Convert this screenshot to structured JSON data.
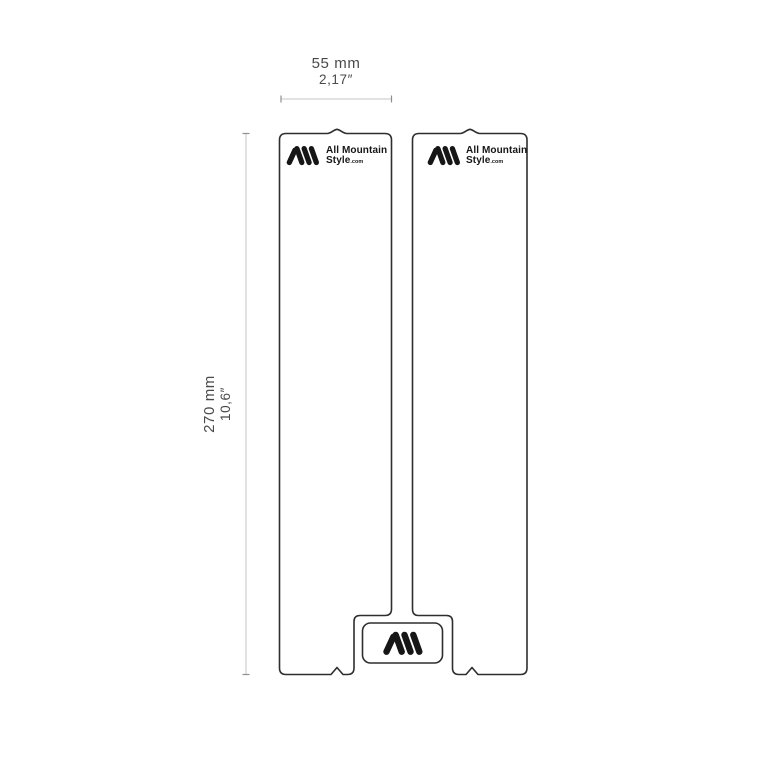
{
  "page": {
    "background": "#ffffff"
  },
  "diagram": {
    "type": "product-dimension-drawing",
    "width_dimension": {
      "metric": "55 mm",
      "imperial": "2,17″"
    },
    "height_dimension": {
      "metric": "270 mm",
      "imperial": "10,6″"
    }
  },
  "brand": {
    "line1": "All Mountain",
    "line2": "Style",
    "suffix": ".com",
    "logo_icon": "ams-triple-stroke-mark"
  },
  "colors": {
    "outline": "#2e2e2e",
    "logo": "#161616",
    "dimension_line": "#c6c6c6",
    "dimension_tick": "#8f8f8f",
    "dimension_text": "#4a4a4a",
    "background": "#ffffff"
  }
}
